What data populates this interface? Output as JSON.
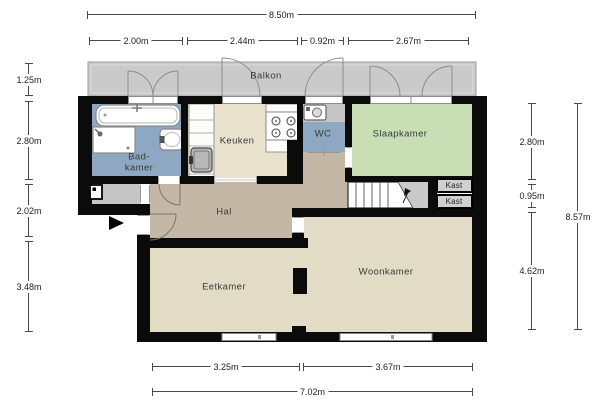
{
  "plan": {
    "rooms": {
      "balkon": "Balkon",
      "badkamer": "Bad-\nkamer",
      "keuken": "Keuken",
      "wc": "WC",
      "slaapkamer": "Slaapkamer",
      "kast_top": "Kast",
      "kast_bottom": "Kast",
      "hal": "Hal",
      "eetkamer": "Eetkamer",
      "woonkamer": "Woonkamer"
    },
    "dimensions": {
      "top_total": "8.50m",
      "top_segments": [
        "2.00m",
        "2.44m",
        "0.92m",
        "2.67m"
      ],
      "left_segments": [
        "1.25m",
        "2.80m",
        "2.02m",
        "3.48m"
      ],
      "right_segments": [
        "2.80m",
        "0.95m",
        "4.62m"
      ],
      "right_total": "8.57m",
      "bottom_segments": [
        "3.25m",
        "3.67m"
      ],
      "bottom_total": "7.02m"
    },
    "colors": {
      "wall": "#0b0b0b",
      "balcony_floor": "#cacaca",
      "bathroom_floor": "#8ea8c3",
      "kitchen_floor": "#e8e1cb",
      "bedroom_floor": "#c8dfb5",
      "hall_floor": "#c4b7a5",
      "living_floor": "#e2dcc6",
      "closet_floor": "#d0d0d0",
      "vestibule_floor": "#c6c6c6"
    },
    "icons": {
      "fixtures": [
        "bathtub-icon",
        "shower-icon",
        "washbasin-icon",
        "kitchen-sink-icon",
        "stove-icon",
        "washing-machine-icon",
        "meter-box-icon",
        "stairs-icon",
        "entrance-arrow-icon"
      ]
    }
  }
}
